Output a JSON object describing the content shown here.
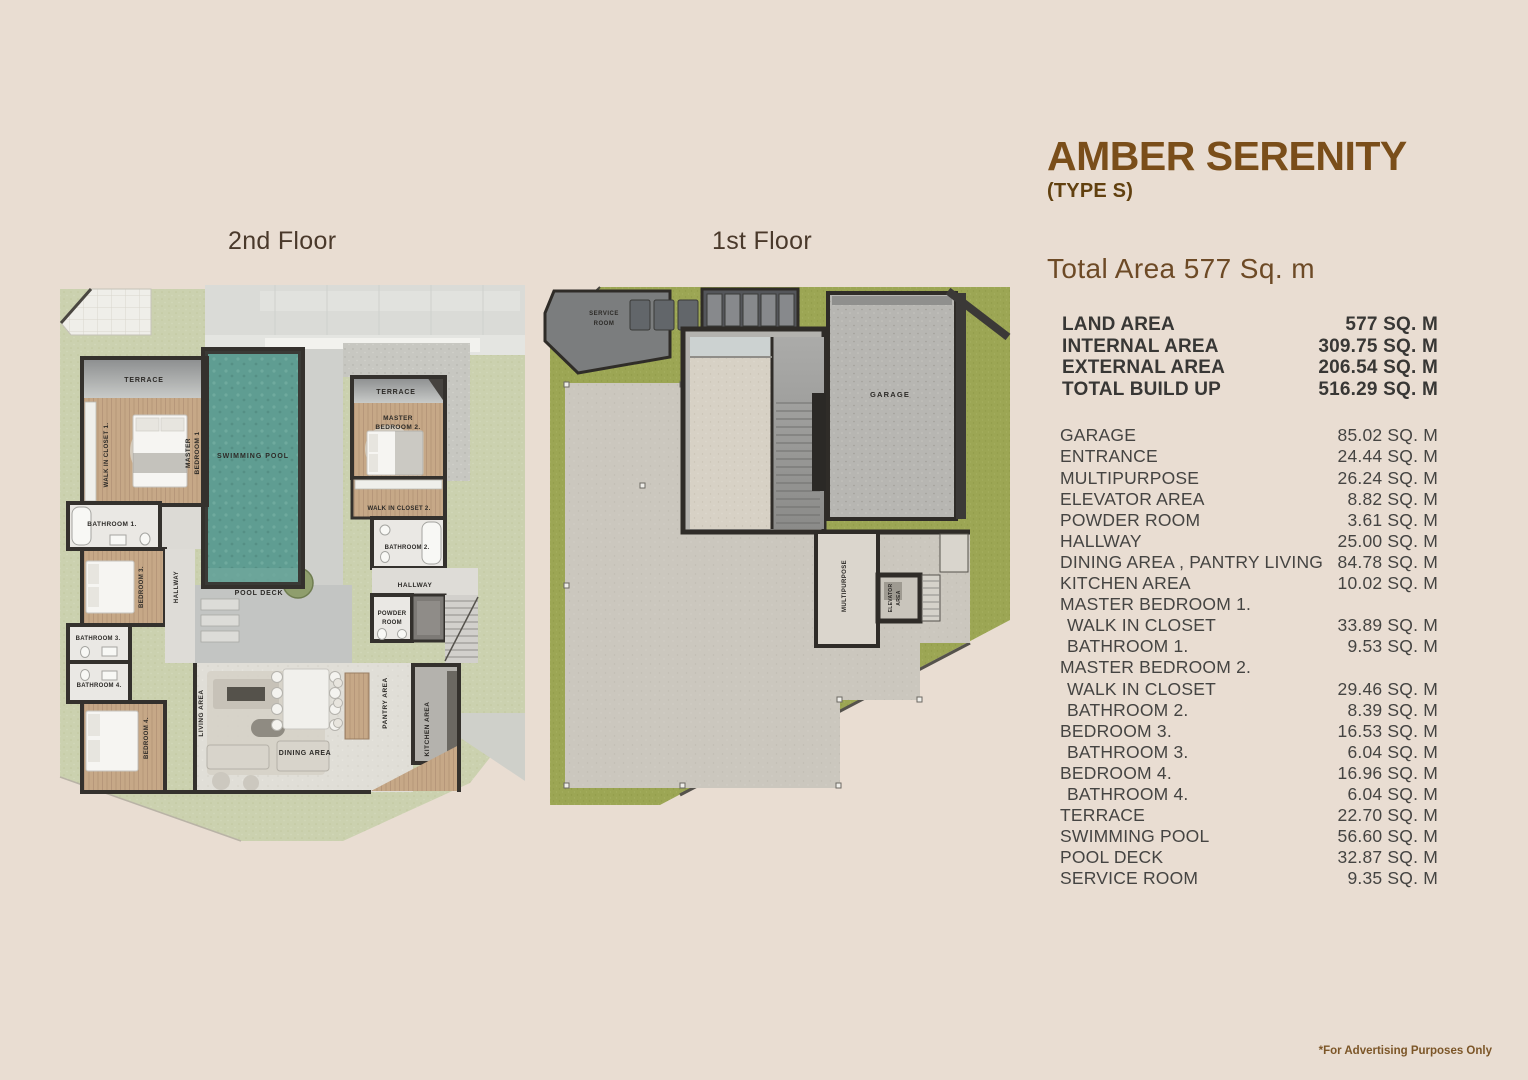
{
  "header": {
    "title": "AMBER SERENITY",
    "type_label": "(TYPE S)",
    "total_area": "Total Area 577 Sq. m",
    "disclaimer": "*For Advertising Purposes Only"
  },
  "floor_labels": {
    "second": "2nd Floor",
    "first": "1st Floor"
  },
  "summary_rows": [
    {
      "label": "LAND AREA",
      "value": "577 SQ. M"
    },
    {
      "label": "INTERNAL AREA",
      "value": "309.75 SQ. M"
    },
    {
      "label": "EXTERNAL AREA",
      "value": "206.54 SQ. M"
    },
    {
      "label": "TOTAL BUILD UP",
      "value": "516.29 SQ. M"
    }
  ],
  "area_rows": [
    {
      "label": "GARAGE",
      "value": "85.02 SQ. M"
    },
    {
      "label": "ENTRANCE",
      "value": "24.44 SQ. M"
    },
    {
      "label": "MULTIPURPOSE",
      "value": "26.24 SQ. M"
    },
    {
      "label": "ELEVATOR AREA",
      "value": "8.82 SQ. M"
    },
    {
      "label": "POWDER ROOM",
      "value": "3.61 SQ. M"
    },
    {
      "label": "HALLWAY",
      "value": "25.00 SQ. M"
    },
    {
      "label": "DINING AREA , PANTRY LIVING",
      "value": "84.78 SQ. M"
    },
    {
      "label": "KITCHEN AREA",
      "value": "10.02 SQ. M"
    },
    {
      "label": "MASTER BEDROOM 1.",
      "value": ""
    },
    {
      "label": "WALK IN CLOSET",
      "value": "33.89 SQ. M",
      "indent": true
    },
    {
      "label": "BATHROOM 1.",
      "value": "9.53 SQ. M",
      "indent": true
    },
    {
      "label": "MASTER BEDROOM 2.",
      "value": ""
    },
    {
      "label": "WALK IN CLOSET",
      "value": "29.46 SQ. M",
      "indent": true
    },
    {
      "label": "BATHROOM 2.",
      "value": "8.39 SQ. M",
      "indent": true
    },
    {
      "label": "BEDROOM 3.",
      "value": "16.53 SQ. M"
    },
    {
      "label": "BATHROOM 3.",
      "value": "6.04 SQ. M",
      "indent": true
    },
    {
      "label": "BEDROOM 4.",
      "value": "16.96 SQ. M"
    },
    {
      "label": "BATHROOM 4.",
      "value": "6.04 SQ. M",
      "indent": true
    },
    {
      "label": "TERRACE",
      "value": "22.70 SQ. M"
    },
    {
      "label": "SWIMMING POOL",
      "value": "56.60 SQ. M"
    },
    {
      "label": "POOL DECK",
      "value": "32.87 SQ. M"
    },
    {
      "label": "SERVICE ROOM",
      "value": "9.35 SQ. M"
    }
  ],
  "plan_second": {
    "terrace_left": "TERRACE",
    "walk_in_closet_1": "WALK IN CLOSET 1.",
    "master_bedroom_1_line1": "MASTER",
    "master_bedroom_1_line2": "BEDROOM 1",
    "swimming_pool": "SWIMMING POOL",
    "bathroom_1": "BATHROOM 1.",
    "bedroom_3": "BEDROOM 3.",
    "hallway_left": "HALLWAY",
    "bathroom_3": "BATHROOM 3.",
    "bathroom_4": "BATHROOM 4.",
    "bedroom_4": "BEDROOM 4.",
    "living_area": "LIVING AREA",
    "pool_deck": "POOL DECK",
    "dining_area": "DINING AREA",
    "pantry_area": "PANTRY AREA",
    "kitchen_area": "KITCHEN AREA",
    "terrace_right": "TERRACE",
    "master_bedroom_2_line1": "MASTER",
    "master_bedroom_2_line2": "BEDROOM 2.",
    "walk_in_closet_2": "WALK IN CLOSET 2.",
    "bathroom_2": "BATHROOM 2.",
    "hallway_right": "HALLWAY",
    "powder_room_line1": "POWDER",
    "powder_room_line2": "ROOM"
  },
  "plan_first": {
    "service_room_line1": "SERVICE",
    "service_room_line2": "ROOM",
    "garage": "GARAGE",
    "multipurpose": "MULTIPURPOSE",
    "elevator_area_line1": "ELEVATOR",
    "elevator_area_line2": "AREA"
  },
  "colors": {
    "background": "#e9ddd2",
    "title_brown": "#7a4e1a",
    "text_dark": "#3f3e3c",
    "grass_second_floor": "#cbd1af",
    "grass_first_floor": "#9ca654",
    "pool_teal": "#5f9d92",
    "wood_floor": "#c6a887",
    "wall_dark": "#34312d"
  }
}
